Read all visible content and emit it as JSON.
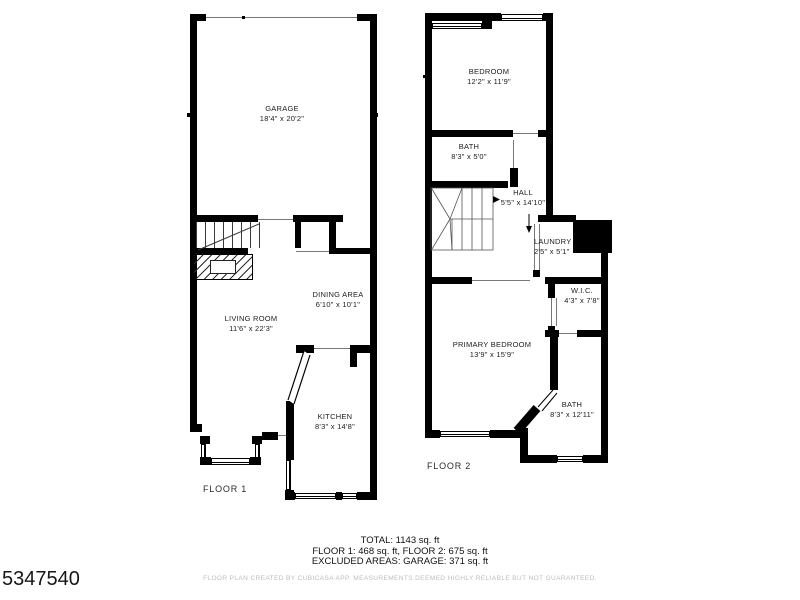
{
  "watermark": {
    "id": "5347540"
  },
  "floor1": {
    "label": "FLOOR 1",
    "rooms": {
      "garage": {
        "name": "GARAGE",
        "dims": "18'4\" x 20'2\""
      },
      "living": {
        "name": "LIVING ROOM",
        "dims": "11'6\" x 22'3\""
      },
      "dining": {
        "name": "DINING AREA",
        "dims": "6'10\" x 10'1\""
      },
      "kitchen": {
        "name": "KITCHEN",
        "dims": "8'3\" x 14'8\""
      }
    }
  },
  "floor2": {
    "label": "FLOOR 2",
    "rooms": {
      "bedroom": {
        "name": "BEDROOM",
        "dims": "12'2\" x 11'9\""
      },
      "bath_top": {
        "name": "BATH",
        "dims": "8'3\" x 5'0\""
      },
      "hall": {
        "name": "HALL",
        "dims": "5'5\" x 14'10\""
      },
      "laundry": {
        "name": "LAUNDRY",
        "dims": "2'5\" x 5'1\""
      },
      "wic": {
        "name": "W.I.C.",
        "dims": "4'3\" x 7'8\""
      },
      "primary": {
        "name": "PRIMARY BEDROOM",
        "dims": "13'9\" x 15'9\""
      },
      "bath_bottom": {
        "name": "BATH",
        "dims": "8'3\" x 12'11\""
      }
    }
  },
  "footer": {
    "total": "TOTAL: 1143 sq. ft",
    "floors": "FLOOR 1: 468 sq. ft, FLOOR 2: 675 sq. ft",
    "excluded": "EXCLUDED AREAS: GARAGE: 371 sq. ft",
    "disclaimer": "FLOOR PLAN CREATED BY CUBICASA APP. MEASUREMENTS DEEMED HIGHLY RELIABLE BUT NOT GUARANTEED."
  }
}
